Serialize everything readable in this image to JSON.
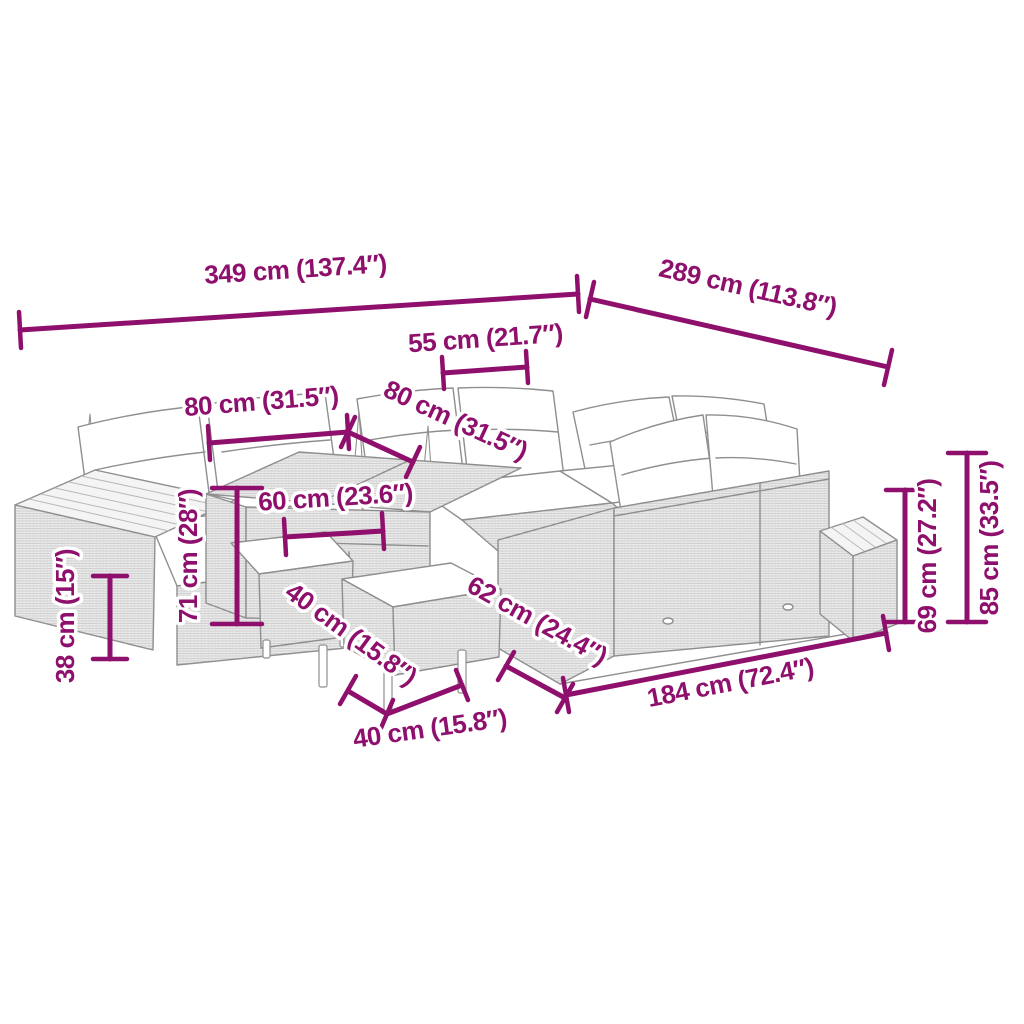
{
  "figure": {
    "type": "product dimension diagram",
    "subject": "poly rattan garden lounge set line drawing",
    "accent_color": "#8E106C",
    "line_color": "#8F8F8F"
  },
  "dimensions": {
    "overall_width": "349 cm (137.4″)",
    "overall_depth": "289 cm (113.8″)",
    "seat_width": "55 cm (21.7″)",
    "section_width": "80 cm (31.5″)",
    "section_depth": "80 cm (31.5″)",
    "table_top_width": "60 cm (23.6″)",
    "table_height": "71 cm (28″)",
    "stool_height": "38 cm (15″)",
    "stool_depth": "40 cm (15.8″)",
    "stool_width": "40 cm (15.8″)",
    "sofa_depth": "62 cm (24.4″)",
    "sofa_length": "184 cm (72.4″)",
    "backrest_height": "69 cm (27.2″)",
    "overall_height": "85 cm (33.5″)"
  }
}
